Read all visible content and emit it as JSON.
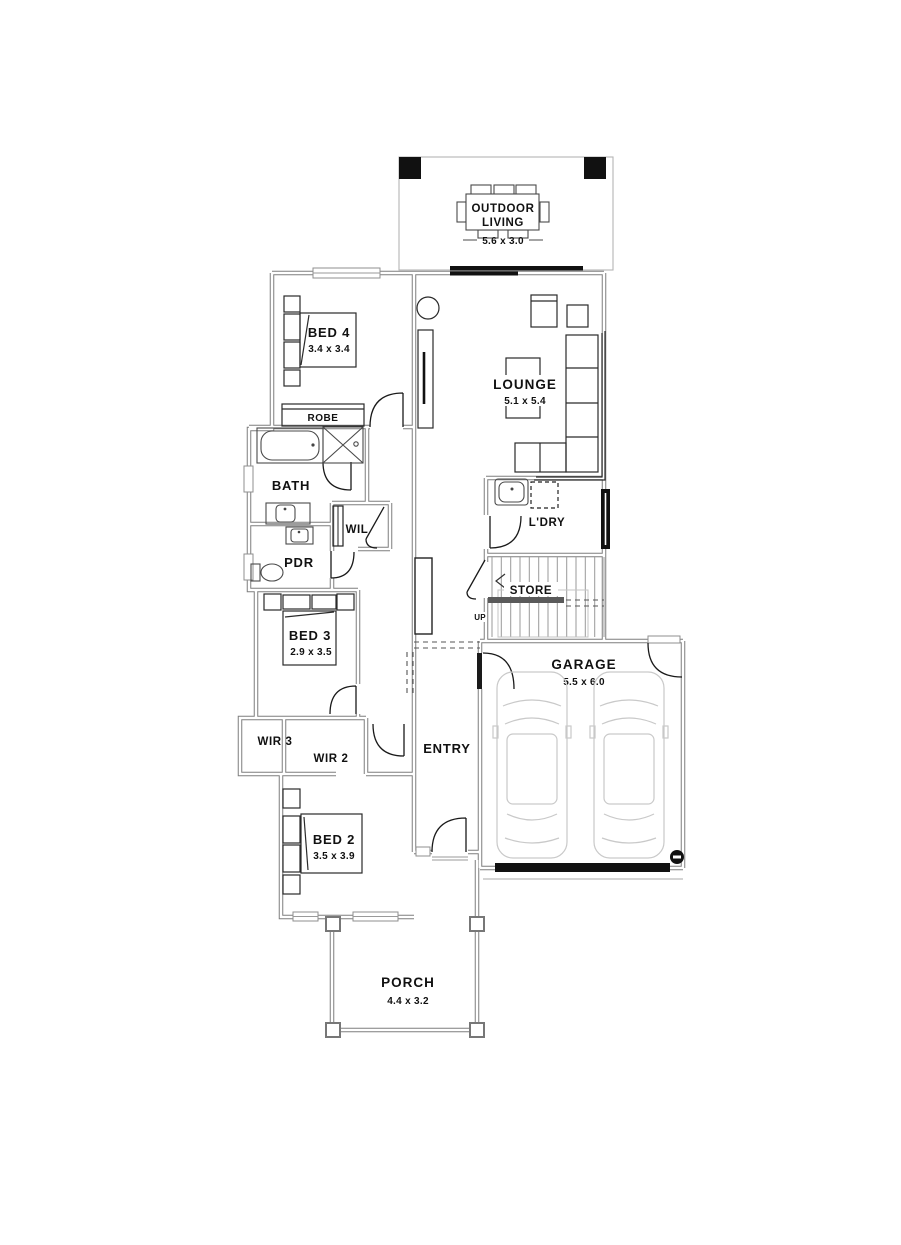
{
  "rooms": {
    "outdoor_living": {
      "line1": "OUTDOOR",
      "line2": "LIVING",
      "dims": "5.6 x 3.0"
    },
    "bed4": {
      "name": "BED 4",
      "dims": "3.4 x 3.4"
    },
    "robe": {
      "name": "ROBE"
    },
    "lounge": {
      "name": "LOUNGE",
      "dims": "5.1 x 5.4"
    },
    "bath": {
      "name": "BATH"
    },
    "wil": {
      "name": "WIL"
    },
    "pdr": {
      "name": "PDR"
    },
    "ldry": {
      "name": "L'DRY"
    },
    "store": {
      "name": "STORE"
    },
    "stairs": {
      "direction": "UP"
    },
    "bed3": {
      "name": "BED 3",
      "dims": "2.9 x 3.5"
    },
    "wir3": {
      "name": "WIR 3"
    },
    "wir2": {
      "name": "WIR 2"
    },
    "entry": {
      "name": "ENTRY"
    },
    "garage": {
      "name": "GARAGE",
      "dims": "5.5 x 6.0"
    },
    "bed2": {
      "name": "BED 2",
      "dims": "3.5 x 3.9"
    },
    "porch": {
      "name": "PORCH",
      "dims": "4.4 x 3.2"
    }
  },
  "colors": {
    "wall": "#7d7d7d",
    "line": "#1a1a1a",
    "light_gray": "#c9c9c9",
    "text": "#111111"
  }
}
